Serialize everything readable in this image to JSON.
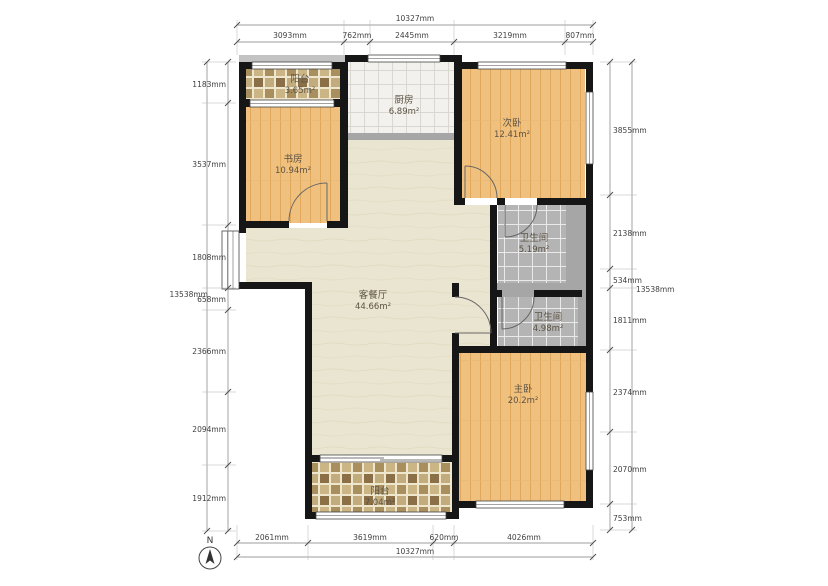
{
  "plan": {
    "rooms": [
      {
        "id": "balcony-top",
        "name": "阳台",
        "area": "3.65m²"
      },
      {
        "id": "study",
        "name": "书房",
        "area": "10.94m²"
      },
      {
        "id": "kitchen",
        "name": "厨房",
        "area": "6.89m²"
      },
      {
        "id": "bedroom-2",
        "name": "次卧",
        "area": "12.41m²"
      },
      {
        "id": "bath-1",
        "name": "卫生间",
        "area": "5.19m²"
      },
      {
        "id": "bath-2",
        "name": "卫生间",
        "area": "4.98m²"
      },
      {
        "id": "living-dining",
        "name": "客餐厅",
        "area": "44.66m²"
      },
      {
        "id": "master-bedroom",
        "name": "主卧",
        "area": "20.2m²"
      },
      {
        "id": "balcony-bottom",
        "name": "阳台",
        "area": "7.04m²"
      }
    ],
    "dims": {
      "top_total": "10327mm",
      "top": [
        "3093mm",
        "762mm",
        "2445mm",
        "3219mm",
        "807mm"
      ],
      "bottom": [
        "2061mm",
        "3619mm",
        "620mm",
        "4026mm"
      ],
      "bottom_total": "10327mm",
      "left": [
        "1183mm",
        "3537mm",
        "1808mm",
        "658mm",
        "2366mm",
        "2094mm",
        "1912mm"
      ],
      "left_total": "13538mm",
      "right": [
        "3855mm",
        "2138mm",
        "534mm",
        "1811mm",
        "2374mm",
        "2070mm",
        "753mm"
      ],
      "right_total": "13538mm"
    },
    "compass": {
      "label": "N"
    }
  },
  "colors": {
    "wall": "#161616",
    "gray_wall": "#a6a6a6",
    "wood_floor": "#f0c17e",
    "living_floor": "#eae5d1",
    "white_tile": "#f2f1ed",
    "gray_tile": "#b4b4b4",
    "mosaic_tile": "#b49a6d",
    "dimension_text": "#3f3f3f"
  }
}
